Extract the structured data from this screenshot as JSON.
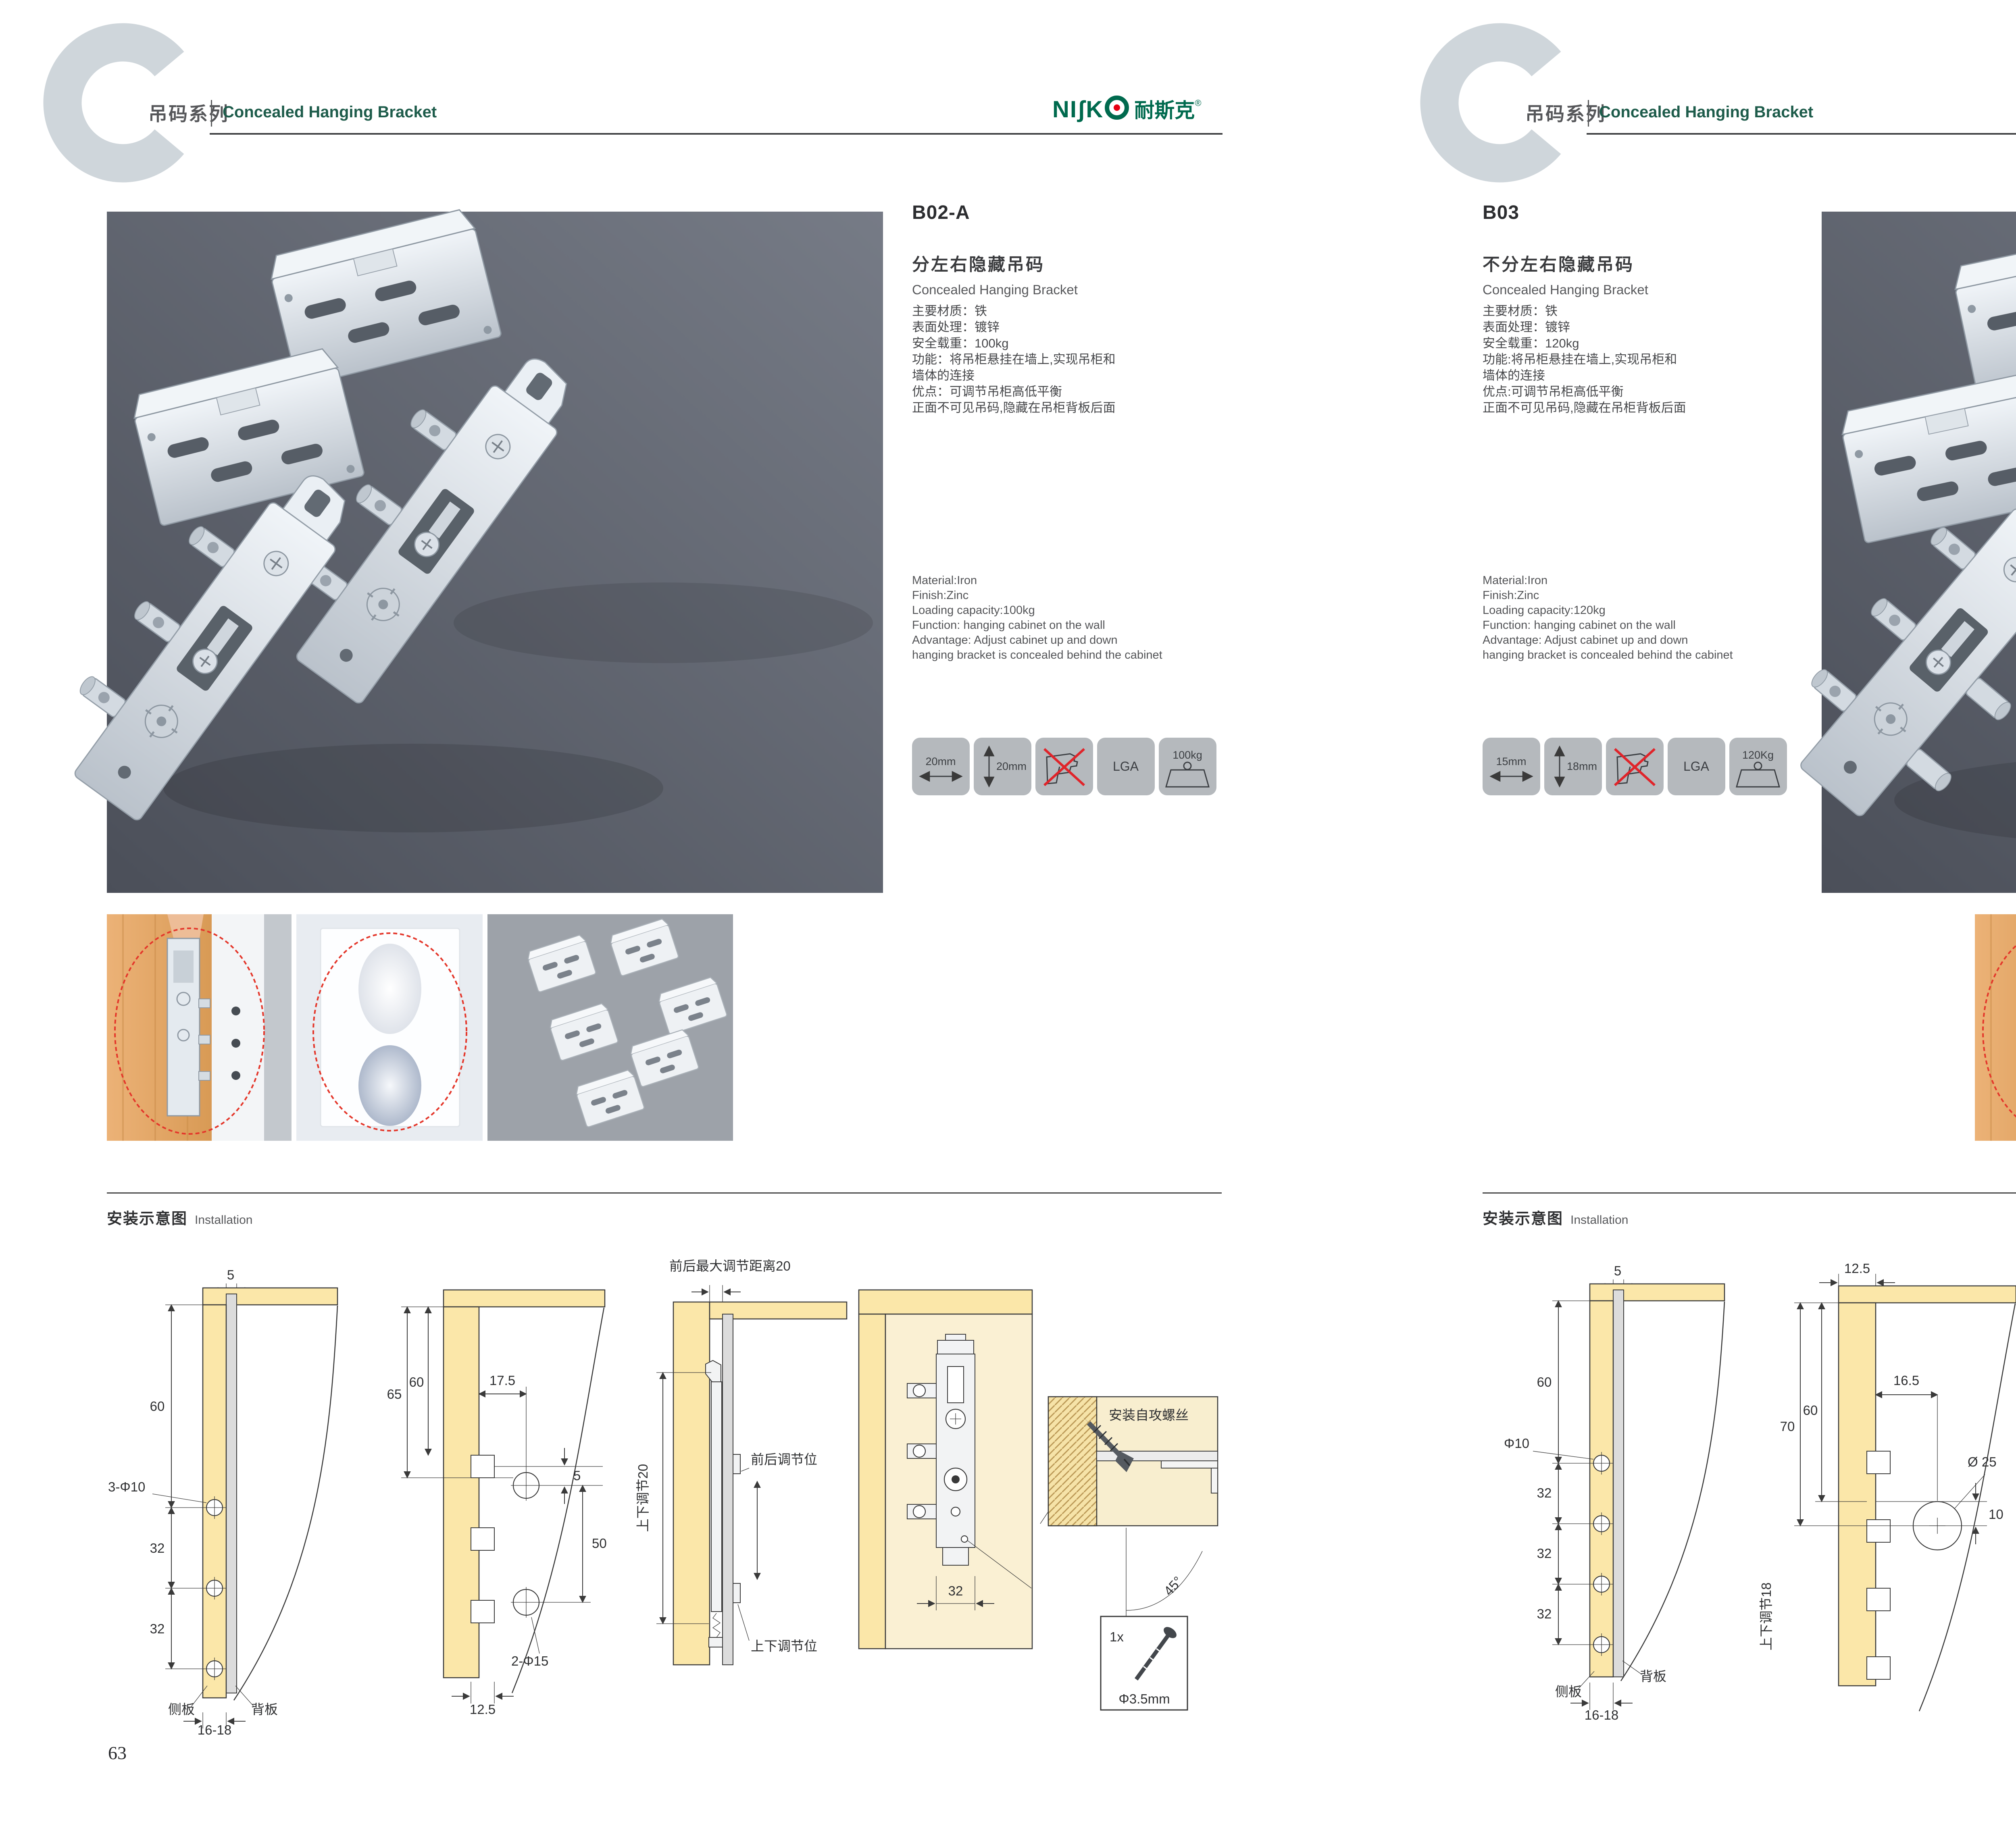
{
  "page": {
    "accent_green": "#1e5c4b",
    "logo_green": "#006a4e",
    "logo_red": "#e60012"
  },
  "header": {
    "series_cn": "吊码系列",
    "series_en": "Concealed Hanging Bracket",
    "logo_latin": "NIʃK",
    "logo_cn": "耐斯克",
    "logo_reg": "®"
  },
  "install": {
    "title_cn": "安装示意图",
    "title_en": "Installation"
  },
  "screw_note": {
    "qty": "1x",
    "dia": "Φ3.5mm",
    "label": "安装自攻螺丝",
    "angle": "45°"
  },
  "left": {
    "page_number": "63",
    "model": "B02-A",
    "title_cn": "分左右隐藏吊码",
    "title_en": "Concealed Hanging Bracket",
    "specs_cn": [
      "主要材质：铁",
      "表面处理：镀锌",
      "安全载重：100kg",
      "功能：将吊柜悬挂在墙上,实现吊柜和",
      "墙体的连接",
      "优点：可调节吊柜高低平衡",
      "正面不可见吊码,隐藏在吊柜背板后面"
    ],
    "specs_en": [
      "Material:Iron",
      "Finish:Zinc",
      "Loading capacity:100kg",
      "Function: hanging cabinet on the wall",
      "Advantage: Adjust cabinet up and down",
      "hanging bracket is concealed behind the cabinet"
    ],
    "icons": {
      "width": "20mm",
      "height": "20mm",
      "cert": "LGA",
      "load": "100kg"
    },
    "d1": {
      "t5": "5",
      "t60": "60",
      "hole": "3-Φ10",
      "t32a": "32",
      "t32b": "32",
      "side": "侧板",
      "back": "背板",
      "tb": "16-18"
    },
    "d2": {
      "t175": "17.5",
      "t65": "65",
      "t60": "60",
      "t5": "5",
      "t50": "50",
      "hole": "2-Φ15",
      "tb": "12.5"
    },
    "d3": {
      "top": "前后最大调节距离20",
      "v": "上下调节20",
      "front": "前后调节位",
      "updown": "上下调节位"
    },
    "d4": {
      "t32": "32"
    }
  },
  "right": {
    "page_number": "64",
    "model": "B03",
    "title_cn": "不分左右隐藏吊码",
    "title_en": "Concealed Hanging Bracket",
    "specs_cn": [
      "主要材质：铁",
      "表面处理：镀锌",
      "安全载重：120kg",
      "功能:将吊柜悬挂在墙上,实现吊柜和",
      "墙体的连接",
      "优点:可调节吊柜高低平衡",
      "正面不可见吊码,隐藏在吊柜背板后面"
    ],
    "specs_en": [
      "Material:Iron",
      "Finish:Zinc",
      "Loading capacity:120kg",
      "Function: hanging cabinet on the wall",
      "Advantage: Adjust cabinet up and down",
      "hanging bracket is concealed behind the cabinet"
    ],
    "icons": {
      "width": "15mm",
      "height": "18mm",
      "cert": "LGA",
      "load": "120Kg"
    },
    "d1": {
      "t5": "5",
      "t60": "60",
      "hole": "Φ10",
      "t32a": "32",
      "t32b": "32",
      "t32c": "32",
      "side": "侧板",
      "back": "背板",
      "tb": "16-18"
    },
    "d2": {
      "tb": "12.5",
      "t70": "70",
      "t60": "60",
      "t165": "16.5",
      "circle": "Ø 25",
      "t10": "10",
      "v": "上下调节18"
    },
    "d3": {
      "t165": "16.5",
      "t125": "12.5",
      "t10": "10",
      "circle": "ø25",
      "lock": "锁紧状态"
    }
  }
}
